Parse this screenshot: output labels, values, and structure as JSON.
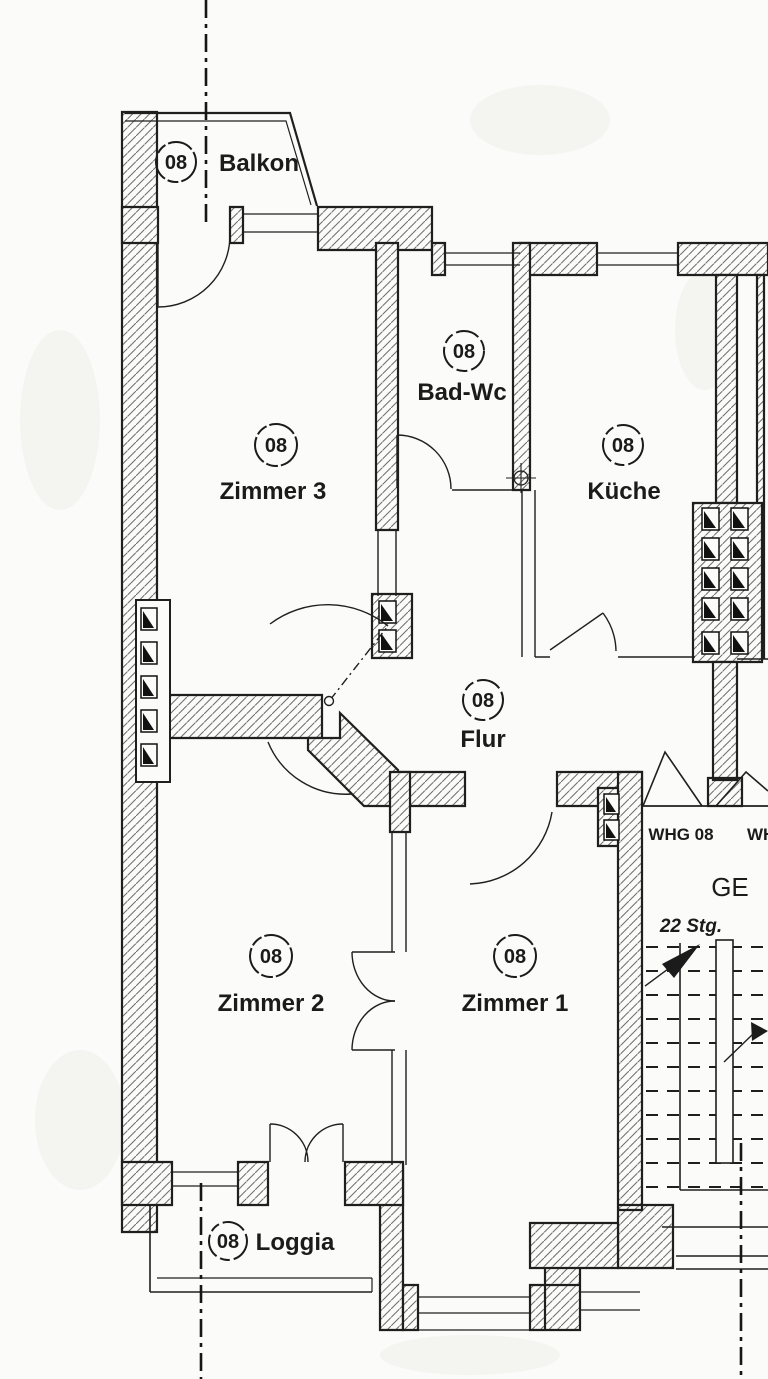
{
  "rooms": [
    {
      "unit": "08",
      "name": "Balkon"
    },
    {
      "unit": "08",
      "name": "Zimmer 3"
    },
    {
      "unit": "08",
      "name": "Bad-Wc"
    },
    {
      "unit": "08",
      "name": "Küche"
    },
    {
      "unit": "08",
      "name": "Flur"
    },
    {
      "unit": "08",
      "name": "Zimmer 2"
    },
    {
      "unit": "08",
      "name": "Zimmer 1"
    },
    {
      "unit": "08",
      "name": "Loggia"
    }
  ],
  "stairwell": {
    "apartment_label": "WHG 08",
    "adjacent_label_partial": "WH",
    "area_label": "GE",
    "stairs_count_label": "22 Stg."
  },
  "colors": {
    "ink": "#1b1b1b",
    "hatch": "#6f6f6f",
    "paper": "#fbfbf9"
  }
}
